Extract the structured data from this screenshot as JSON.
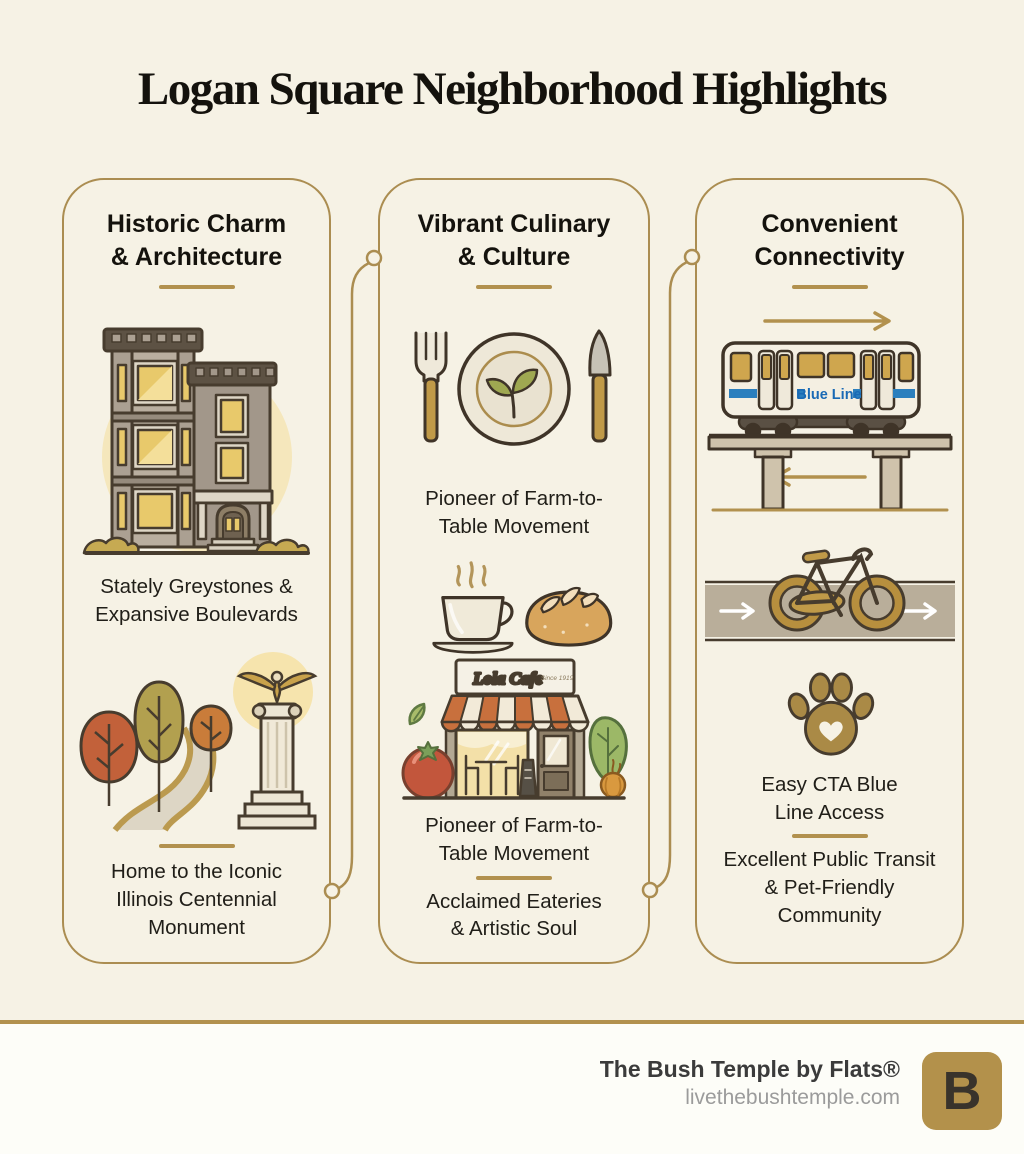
{
  "title": "Logan Square Neighborhood Highlights",
  "colors": {
    "background": "#f6f2e5",
    "gold_accent": "#b2914e",
    "card_border": "#ab8d51",
    "text_dark": "#1f1d18",
    "blue_line_blue": "#1a6ab5",
    "footer_background": "#fdfdf8",
    "logo_gold": "#b3914b"
  },
  "cards": [
    {
      "id": "historic",
      "title": "Historic Charm\n& Architecture",
      "icons": [
        "greystone-building-icon",
        "park-path-monument-icon"
      ],
      "captions": [
        "Stately Greystones &\nExpansive Boulevards",
        "Home to the Iconic\nIllinois Centennial\nMonument"
      ]
    },
    {
      "id": "culinary",
      "title": "Vibrant Culinary\n& Culture",
      "icons": [
        "place-setting-icon",
        "coffee-and-bread-icon",
        "cafe-storefront-icon"
      ],
      "cafe_sign": "Lola Cafe",
      "cafe_sign_since": "Since 1919",
      "captions": [
        "Pioneer of Farm-to-\nTable Movement",
        "Pioneer of Farm-to-\nTable Movement",
        "Acclaimed Eateries\n& Artistic Soul"
      ]
    },
    {
      "id": "connectivity",
      "title": "Convenient\nConnectivity",
      "icons": [
        "blue-line-train-icon",
        "bike-lane-icon",
        "paw-print-icon"
      ],
      "train_label": "Blue Line",
      "captions": [
        "Easy CTA Blue\nLine Access",
        "Excellent Public Transit\n& Pet-Friendly\nCommunity"
      ]
    }
  ],
  "footer": {
    "brand": "The Bush Temple by Flats®",
    "website": "livethebushtemple.com",
    "logo_letter": "B"
  }
}
